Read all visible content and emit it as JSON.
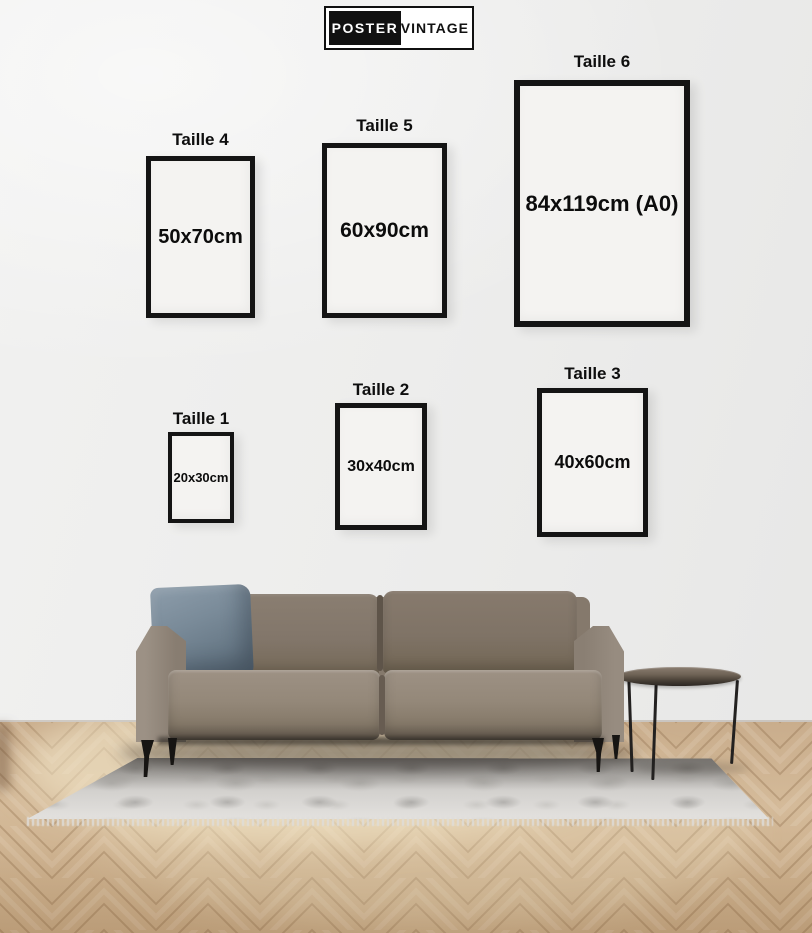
{
  "logo": {
    "left_text": "POSTER",
    "right_text": "VINTAGE"
  },
  "sizes": [
    {
      "label": "Taille 4",
      "dimensions": "50x70cm"
    },
    {
      "label": "Taille 5",
      "dimensions": "60x90cm"
    },
    {
      "label": "Taille 6",
      "dimensions": "84x119cm (A0)"
    },
    {
      "label": "Taille 1",
      "dimensions": "20x30cm"
    },
    {
      "label": "Taille 2",
      "dimensions": "30x40cm"
    },
    {
      "label": "Taille 3",
      "dimensions": "40x60cm"
    }
  ],
  "colors": {
    "wall": "#ededec",
    "frame_border": "#141414",
    "frame_interior": "#f4f3f1",
    "text": "#0e0e0e",
    "floor_wood": "#cfb494",
    "rug": "#d3d1ce",
    "sofa": "#8a7e71",
    "pillow": "#7a8b99",
    "logo_black": "#111111",
    "logo_white": "#ffffff"
  }
}
